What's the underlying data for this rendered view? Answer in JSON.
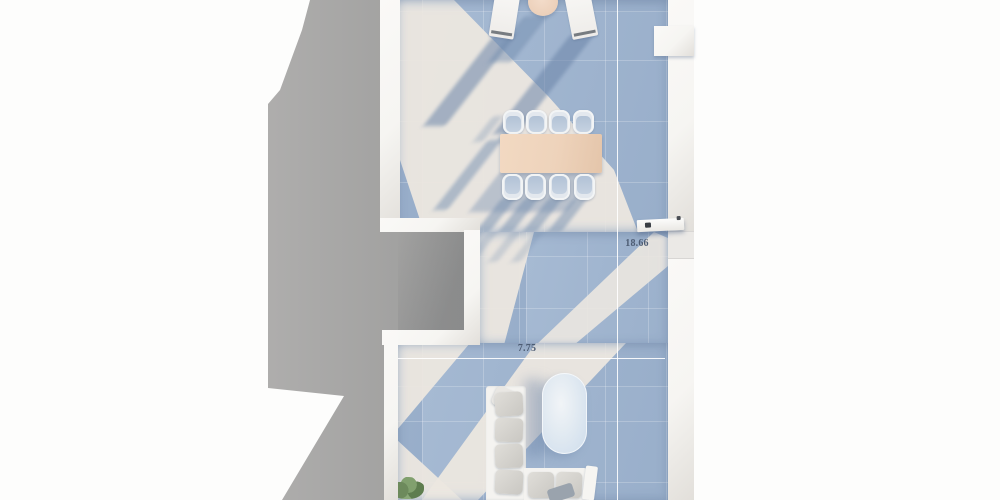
{
  "scene": {
    "type": "3d-floor-plan-render",
    "description": "Top-down 3D render of a narrow apartment terrace floor plan on a white background with a long gray building shadow cast to the left"
  },
  "dimensions": {
    "vertical_label": "18.66",
    "horizontal_label": "7.75"
  },
  "rooms": [
    {
      "name": "upper-terrace",
      "features": [
        "sun loungers",
        "round side table",
        "dining table with 8 chairs"
      ]
    },
    {
      "name": "middle-passage",
      "features": [
        "entry door on right wall",
        "sunlight beam across floor"
      ]
    },
    {
      "name": "lower-lounge",
      "features": [
        "L-shaped sectional sofa",
        "oval tub",
        "potted plant"
      ]
    }
  ],
  "furniture": [
    {
      "name": "sun-lounger",
      "count": 2,
      "area": "upper-terrace"
    },
    {
      "name": "round-side-table",
      "count": 1,
      "area": "upper-terrace"
    },
    {
      "name": "dining-table",
      "count": 1,
      "area": "upper-terrace"
    },
    {
      "name": "dining-chair",
      "count": 8,
      "area": "upper-terrace"
    },
    {
      "name": "sectional-sofa",
      "count": 1,
      "area": "lower-lounge"
    },
    {
      "name": "oval-tub",
      "count": 1,
      "area": "lower-lounge"
    },
    {
      "name": "potted-plant",
      "count": 1,
      "area": "lower-lounge"
    },
    {
      "name": "door",
      "count": 1,
      "area": "right-wall"
    }
  ],
  "colors": {
    "background": "#fdfdfc",
    "shadow_gray_light": "#b0afae",
    "shadow_gray_dark": "#9c9c9b",
    "floor_blue": "#a6bad3",
    "floor_blue_dark": "#97adc9",
    "floor_lit": "#ece7e0",
    "wall": "#f6f5f2",
    "table_wood": "#eed3bb",
    "text_dim": "#4d5c73",
    "oval_blue": "#cddcec",
    "cushion": "#d9d7d2",
    "plant_green": "#76935f"
  }
}
